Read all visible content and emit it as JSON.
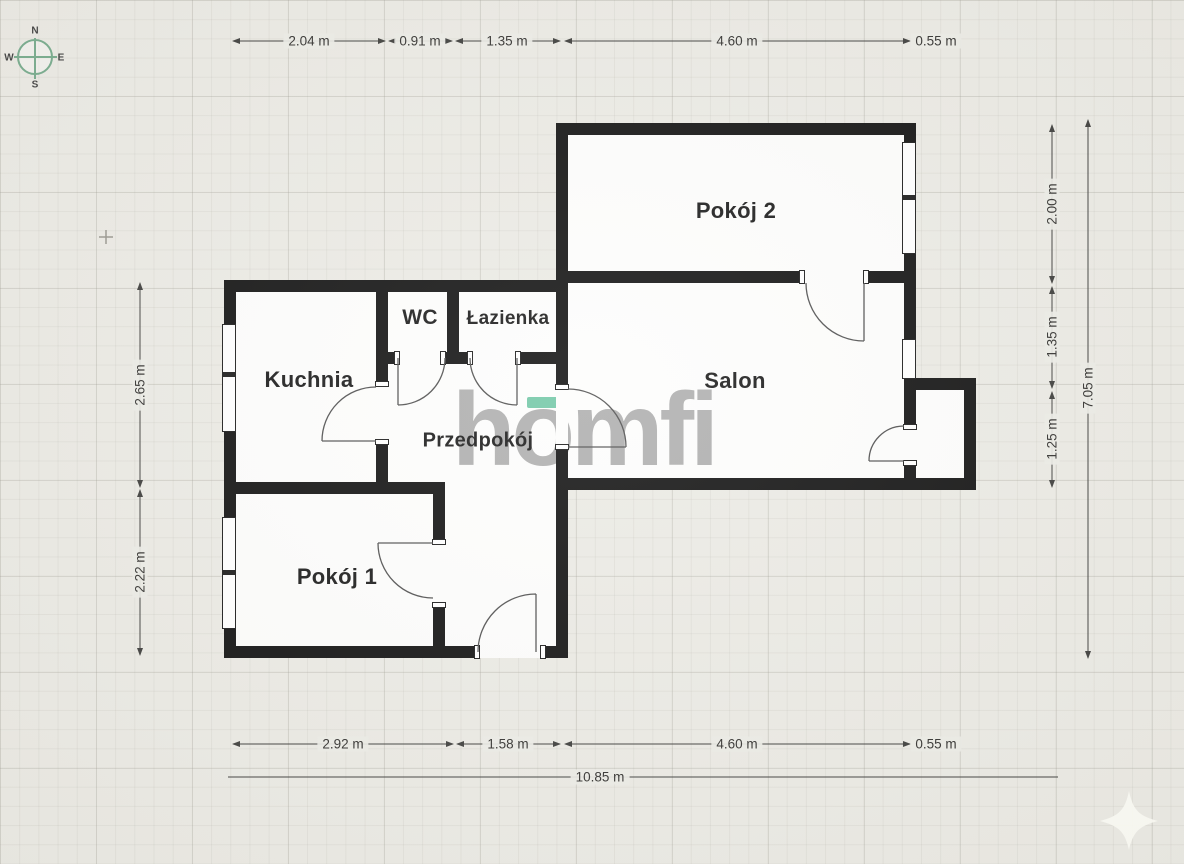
{
  "plan": {
    "rooms": [
      {
        "label": "Pokój 2"
      },
      {
        "label": "Kuchnia"
      },
      {
        "label": "WC"
      },
      {
        "label": "Łazienka"
      },
      {
        "label": "Salon"
      },
      {
        "label": "Przedpokój"
      },
      {
        "label": "Pokój 1"
      }
    ]
  },
  "dims": {
    "top": [
      "2.04 m",
      "0.91 m",
      "1.35 m",
      "4.60 m",
      "0.55 m"
    ],
    "bottom": [
      "2.92 m",
      "1.58 m",
      "4.60 m",
      "0.55 m"
    ],
    "bottom_total": "10.85 m",
    "right": [
      "2.00 m",
      "1.35 m",
      "1.25 m"
    ],
    "right_total": "7.05 m",
    "left": [
      "2.65 m",
      "2.22 m"
    ]
  },
  "compass": {
    "n": "N",
    "e": "E",
    "s": "S",
    "w": "W"
  },
  "watermark": {
    "text": "homfi",
    "accent_color": "#58bd97",
    "text_color": "#8f8f8f"
  },
  "icons": {
    "compass": "compass-rose-icon",
    "sparkle": "four-point-star-icon"
  },
  "colors": {
    "wall": "#0d0d0d",
    "background": "#ebeae4",
    "compass_green": "#74a98a"
  }
}
